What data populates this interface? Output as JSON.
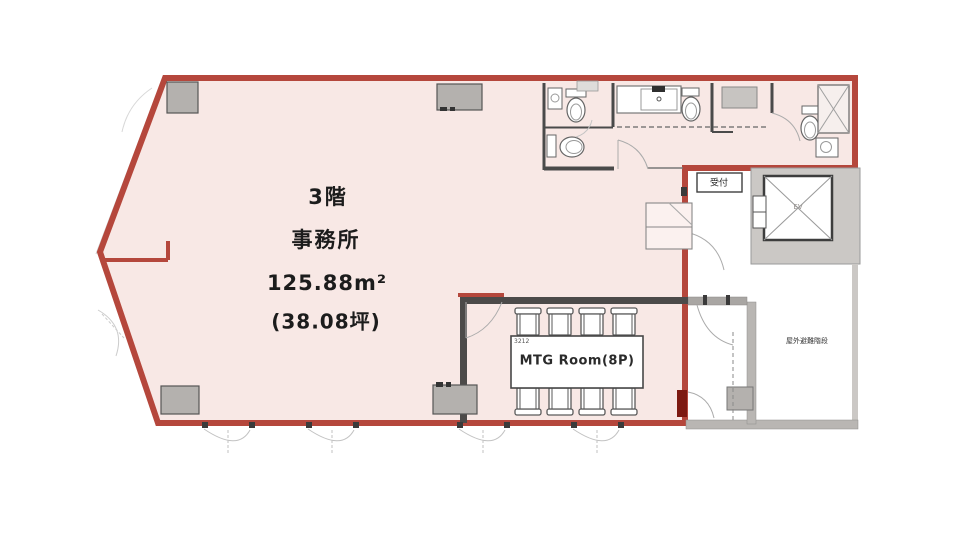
{
  "plan": {
    "office": {
      "floor_label": "3階",
      "use_label": "事務所",
      "area_m2": "125.88m²",
      "area_tsubo": "(38.08坪)"
    },
    "mtg_room": {
      "label": "MTG Room(8P)",
      "table_code": "3212",
      "seats": 8
    },
    "reception": {
      "label": "受付"
    },
    "elevator": {
      "label": "EV"
    },
    "escape_stairs": {
      "label": "屋外避難階段"
    }
  },
  "colors": {
    "lease_fill": "#f8e8e5",
    "lease_stroke": "#b5473c",
    "wall_gray": "#b9b6b3",
    "dark_wall": "#4c4a49",
    "door_red": "#7d1a12",
    "fixture_line": "#5a5a5a"
  }
}
